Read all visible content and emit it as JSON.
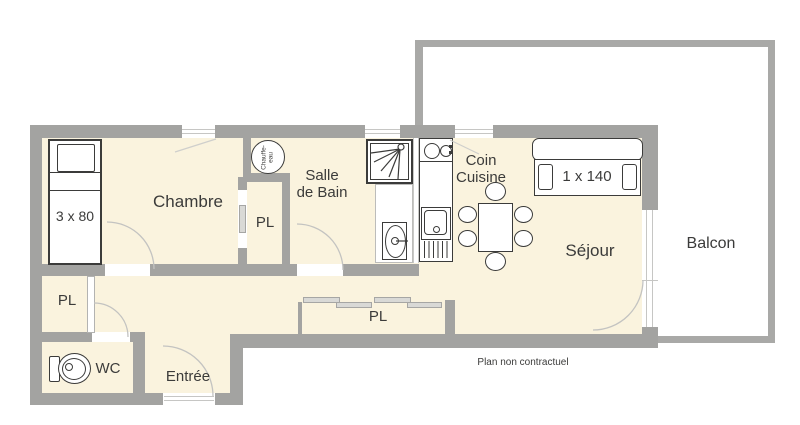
{
  "theme": {
    "wall": "#a3a3a1",
    "balcony_wall": "#a9a9a7",
    "floor": "#faf3de",
    "ink": "#3b3b3a",
    "arc": "#c3c3c1"
  },
  "plan": {
    "rooms": {
      "chambre": "Chambre",
      "salle_de_bain": "Salle\nde Bain",
      "coin_cuisine": "Coin\nCuisine",
      "sejour": "Séjour",
      "balcon": "Balcon",
      "entree": "Entrée",
      "wc": "WC",
      "placard": "PL"
    },
    "furniture": {
      "single_bed": "3 x 80",
      "double_bed": "1 x 140",
      "water_heater": "Chauffe-eau"
    },
    "footnote": "Plan non contractuel"
  }
}
